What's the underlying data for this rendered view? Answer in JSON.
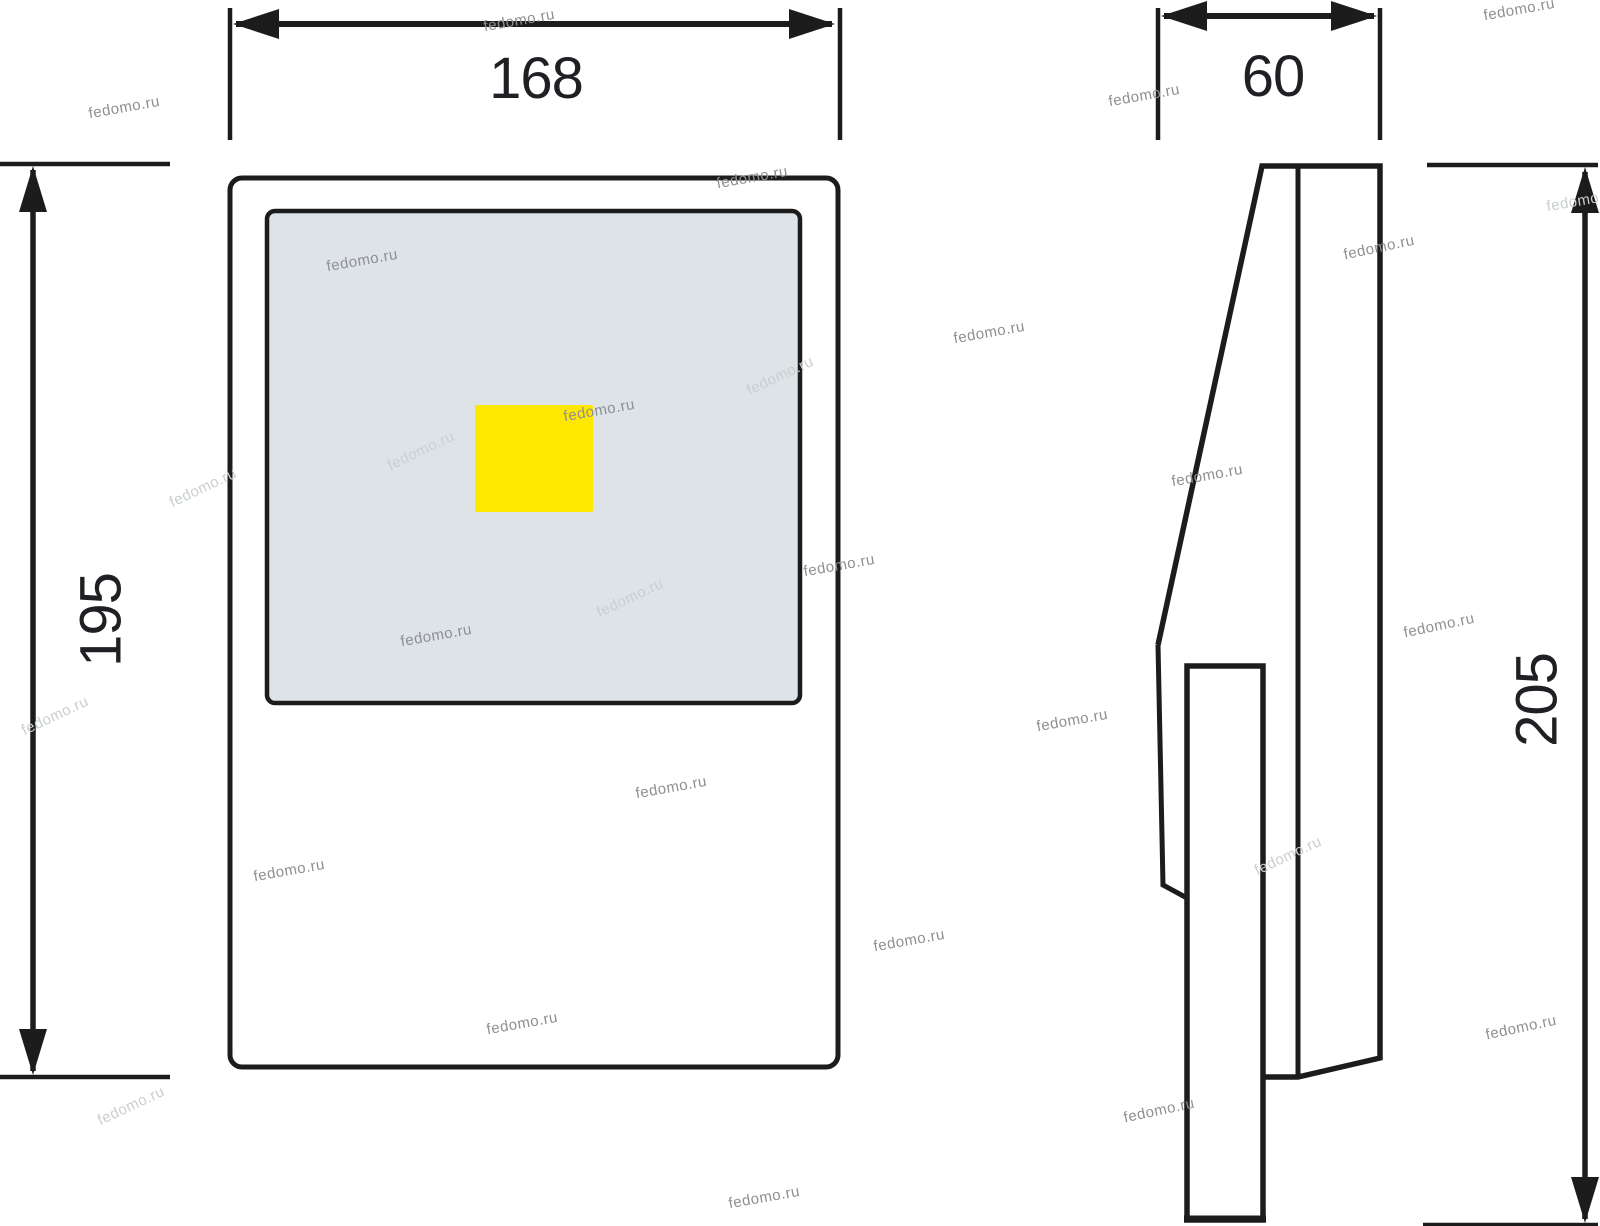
{
  "dimensions": {
    "front_width": "168",
    "depth": "60",
    "front_height": "195",
    "overall_height": "205"
  },
  "colors": {
    "line": "#1c1c1c",
    "panel_fill": "#dde3e7",
    "led_fill": "#ffe800",
    "dim_text": "#1f2023",
    "watermark": "#8d8f92",
    "watermark_light": "#c9ced1"
  },
  "watermark": {
    "text": "fedomo.ru",
    "instances": [
      {
        "x": 125,
        "y": 112,
        "angle": -10,
        "light": false
      },
      {
        "x": 520,
        "y": 25,
        "angle": -10,
        "light": false
      },
      {
        "x": 753,
        "y": 182,
        "angle": -10,
        "light": false
      },
      {
        "x": 1145,
        "y": 100,
        "angle": -10,
        "light": false
      },
      {
        "x": 1520,
        "y": 14,
        "angle": -10,
        "light": false
      },
      {
        "x": 1583,
        "y": 205,
        "angle": -10,
        "light": true
      },
      {
        "x": 363,
        "y": 265,
        "angle": -10,
        "light": false
      },
      {
        "x": 1380,
        "y": 252,
        "angle": -12,
        "light": false
      },
      {
        "x": 990,
        "y": 337,
        "angle": -10,
        "light": false
      },
      {
        "x": 600,
        "y": 415,
        "angle": -10,
        "light": false
      },
      {
        "x": 782,
        "y": 380,
        "angle": -25,
        "light": true
      },
      {
        "x": 423,
        "y": 455,
        "angle": -25,
        "light": true
      },
      {
        "x": 1208,
        "y": 480,
        "angle": -10,
        "light": false
      },
      {
        "x": 205,
        "y": 492,
        "angle": -25,
        "light": true
      },
      {
        "x": 840,
        "y": 570,
        "angle": -10,
        "light": false
      },
      {
        "x": 632,
        "y": 602,
        "angle": -25,
        "light": true
      },
      {
        "x": 437,
        "y": 640,
        "angle": -10,
        "light": false
      },
      {
        "x": 1440,
        "y": 630,
        "angle": -12,
        "light": false
      },
      {
        "x": 57,
        "y": 720,
        "angle": -25,
        "light": true
      },
      {
        "x": 1073,
        "y": 725,
        "angle": -10,
        "light": false
      },
      {
        "x": 672,
        "y": 792,
        "angle": -10,
        "light": false
      },
      {
        "x": 290,
        "y": 875,
        "angle": -10,
        "light": false
      },
      {
        "x": 1290,
        "y": 860,
        "angle": -25,
        "light": true
      },
      {
        "x": 910,
        "y": 945,
        "angle": -10,
        "light": false
      },
      {
        "x": 523,
        "y": 1028,
        "angle": -10,
        "light": false
      },
      {
        "x": 1522,
        "y": 1032,
        "angle": -12,
        "light": false
      },
      {
        "x": 133,
        "y": 1110,
        "angle": -25,
        "light": true
      },
      {
        "x": 1160,
        "y": 1115,
        "angle": -12,
        "light": false
      },
      {
        "x": 765,
        "y": 1202,
        "angle": -10,
        "light": false
      }
    ]
  }
}
